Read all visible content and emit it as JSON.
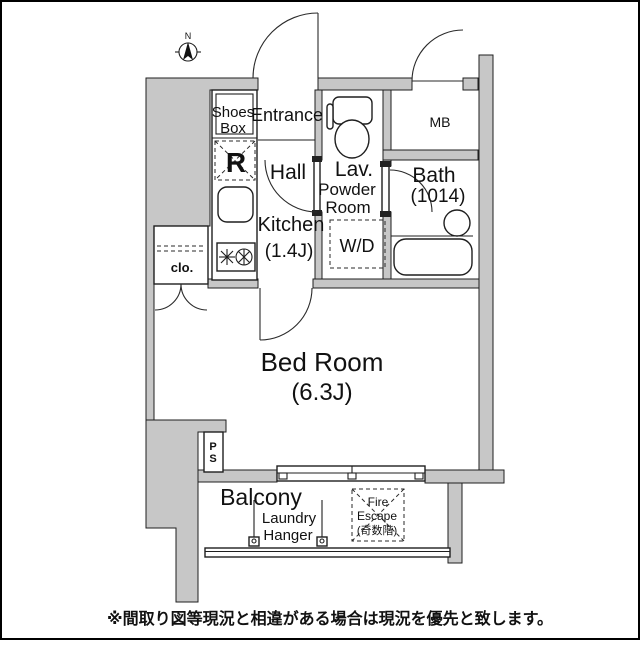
{
  "colors": {
    "wall_fill": "#c7c7c7",
    "line": "#1f1f1f",
    "background": "#ffffff"
  },
  "compass": {
    "north_label": "N"
  },
  "labels": {
    "shoes_box_line1": "Shoes",
    "shoes_box_line2": "Box",
    "entrance": "Entrance",
    "refrigerator_space": "R",
    "hall": "Hall",
    "kitchen_name": "Kitchen",
    "kitchen_size": "(1.4J)",
    "closet": "clo.",
    "lavatory": "Lav.",
    "powder_line1": "Powder",
    "powder_line2": "Room",
    "washer_dryer": "W/D",
    "meter_box": "MB",
    "bath_name": "Bath",
    "bath_size": "(1014)",
    "bedroom_name": "Bed Room",
    "bedroom_size": "(6.3J)",
    "pipe_space_line1": "P",
    "pipe_space_line2": "S",
    "balcony": "Balcony",
    "laundry_line1": "Laundry",
    "laundry_line2": "Hanger",
    "fire_escape_line1": "Fire",
    "fire_escape_line2": "Escape",
    "fire_escape_line3": "(奇数階)"
  },
  "caption": "※間取り図等現況と相違がある場合は現況を優先と致します。"
}
